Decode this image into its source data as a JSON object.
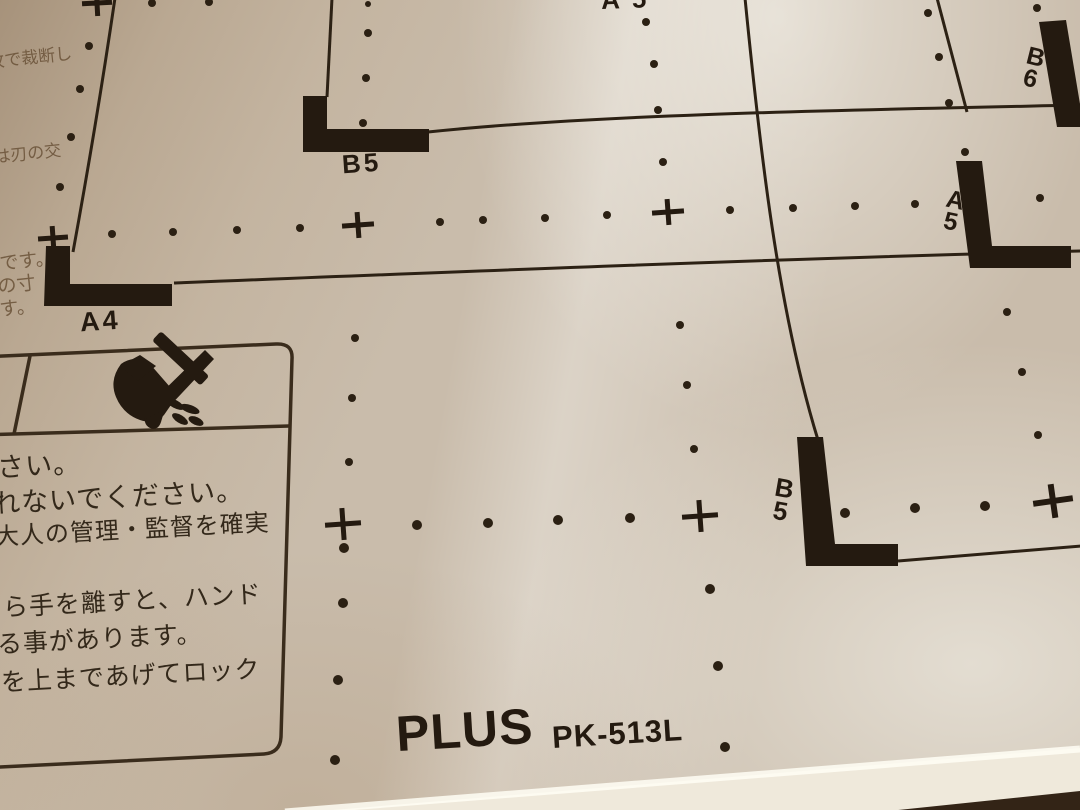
{
  "brand": {
    "logo": "PLUS",
    "model": "PK-513L"
  },
  "size_labels": {
    "top_edge_partial": "A5",
    "b5_portrait": "B5",
    "a4_portrait": "A4",
    "b6_landscape": "B\n6",
    "a5_landscape": "A\n5",
    "b5_landscape": "B\n5"
  },
  "margin_notes": {
    "line1": "枚で裁断し",
    "line2": "は刃の交",
    "line3": "です。",
    "line4": "の寸",
    "line5": "す。"
  },
  "warning_box": {
    "icon": "hand-blade-cut-warning-icon",
    "lines": [
      "さい。",
      "れないでください。",
      "大人の管理・監督を確実",
      "ら手を離すと、ハンド",
      "る事があります。",
      "を上まであげてロック"
    ]
  },
  "colors": {
    "plate_base": "#c9bcab",
    "ink": "#241a10",
    "faded_ink": "#6a5238",
    "box_line": "#3a2c1c"
  }
}
